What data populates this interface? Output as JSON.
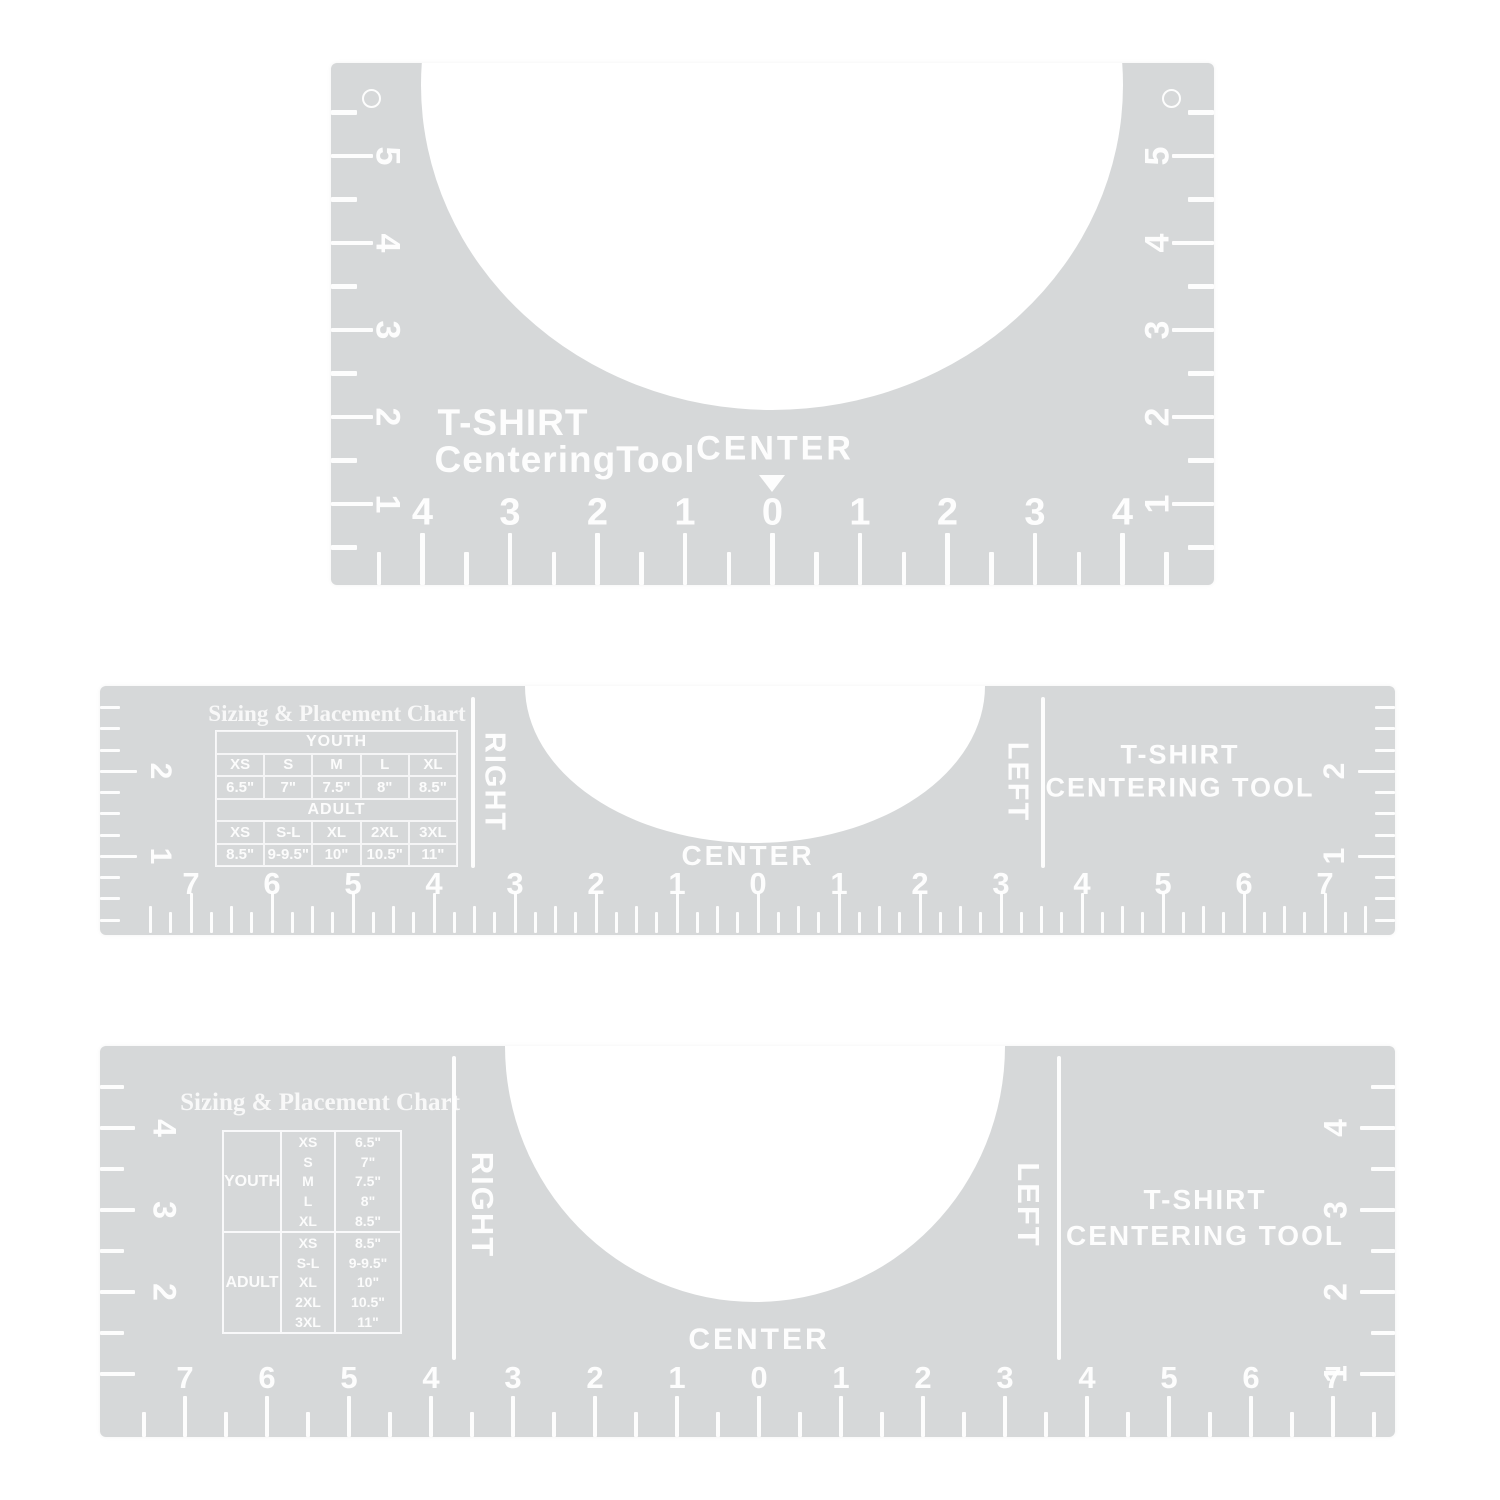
{
  "colors": {
    "tool_gray": "#d6d8d9",
    "marking_white": "#ffffff"
  },
  "tool_top": {
    "title_line1": "T-SHIRT",
    "title_line2": "CenteringTool",
    "center_label": "CENTER",
    "side_scale": [
      "5",
      "4",
      "3",
      "2",
      "1"
    ],
    "bottom_scale": [
      "4",
      "3",
      "2",
      "1",
      "0",
      "1",
      "2",
      "3",
      "4"
    ]
  },
  "tool_middle": {
    "chart": {
      "title": "Sizing & Placement Chart",
      "youth_header": "YOUTH",
      "adult_header": "ADULT",
      "youth_sizes": [
        "XS",
        "S",
        "M",
        "L",
        "XL"
      ],
      "youth_values": [
        "6.5\"",
        "7\"",
        "7.5\"",
        "8\"",
        "8.5\""
      ],
      "adult_sizes": [
        "XS",
        "S-L",
        "XL",
        "2XL",
        "3XL"
      ],
      "adult_values": [
        "8.5\"",
        "9-9.5\"",
        "10\"",
        "10.5\"",
        "11\""
      ]
    },
    "right_label": "RIGHT",
    "left_label": "LEFT",
    "center_label": "CENTER",
    "brand_line1": "T-SHIRT",
    "brand_line2": "CENTERING TOOL",
    "side_scale": [
      "2",
      "1"
    ],
    "bottom_scale": [
      "7",
      "6",
      "5",
      "4",
      "3",
      "2",
      "1",
      "0",
      "1",
      "2",
      "3",
      "4",
      "5",
      "6",
      "7"
    ]
  },
  "tool_bottom": {
    "chart": {
      "title": "Sizing & Placement Chart",
      "groups": [
        {
          "label": "YOUTH",
          "sizes": [
            "XS",
            "S",
            "M",
            "L",
            "XL"
          ],
          "values": [
            "6.5\"",
            "7\"",
            "7.5\"",
            "8\"",
            "8.5\""
          ]
        },
        {
          "label": "ADULT",
          "sizes": [
            "XS",
            "S-L",
            "XL",
            "2XL",
            "3XL"
          ],
          "values": [
            "8.5\"",
            "9-9.5\"",
            "10\"",
            "10.5\"",
            "11\""
          ]
        }
      ]
    },
    "right_label": "RIGHT",
    "left_label": "LEFT",
    "center_label": "CENTER",
    "brand_line1": "T-SHIRT",
    "brand_line2": "CENTERING TOOL",
    "left_scale": [
      "4",
      "3",
      "2"
    ],
    "right_scale": [
      "4",
      "3",
      "2",
      "1"
    ],
    "bottom_scale": [
      "7",
      "6",
      "5",
      "4",
      "3",
      "2",
      "1",
      "0",
      "1",
      "2",
      "3",
      "4",
      "5",
      "6",
      "7"
    ]
  }
}
